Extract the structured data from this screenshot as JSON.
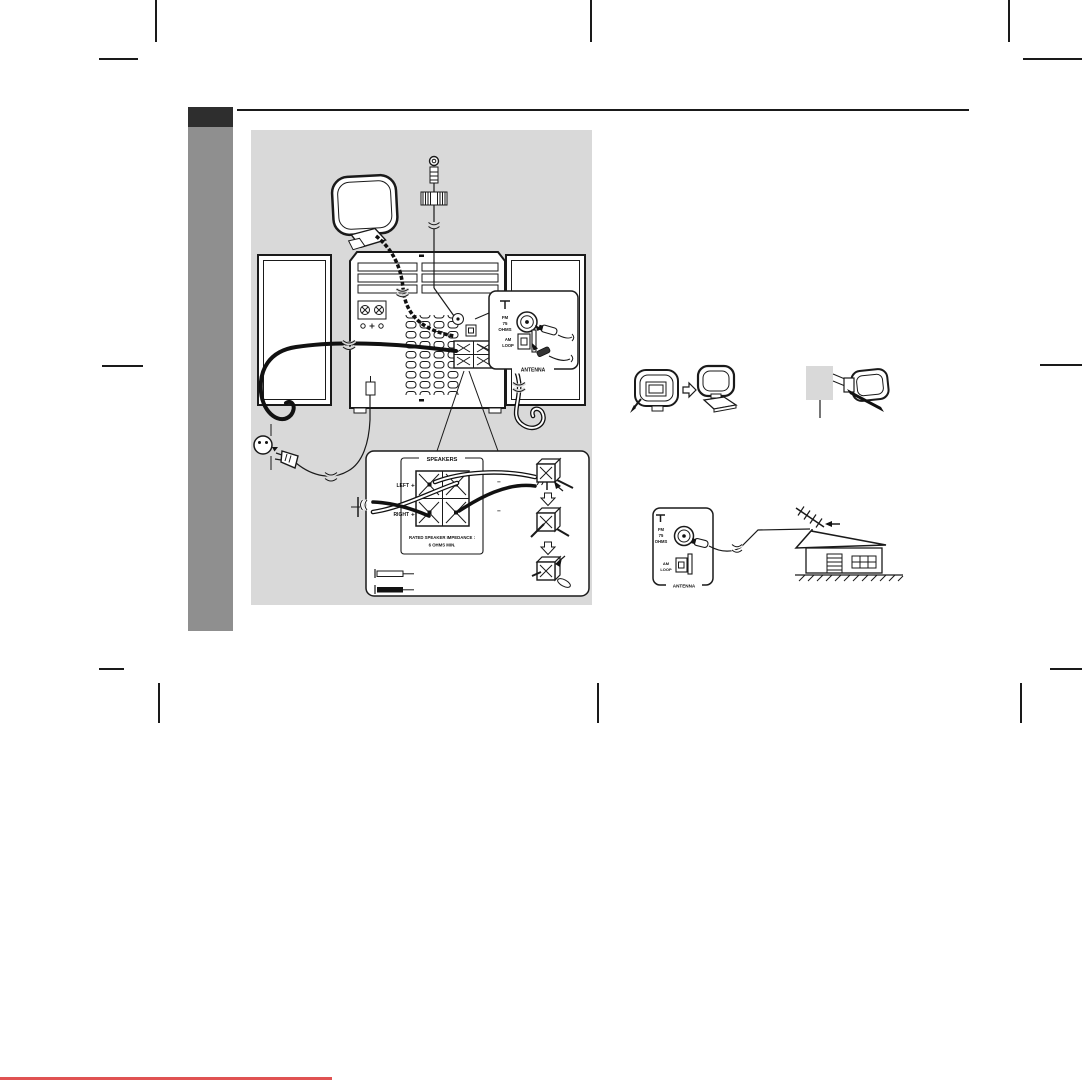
{
  "page": {
    "background": "#ffffff",
    "line_color": "#1a1a1a",
    "diagram_bg": "#d9d9d9",
    "sidebar_tab_color": "#2e2e2e",
    "sidebar_bar_color": "#8f8f8f",
    "red_rule_color": "#e05252"
  },
  "antenna_panel": {
    "fm_line1": "FM",
    "fm_line2": "75",
    "fm_line3": "OHMS",
    "am_line1": "AM",
    "am_line2": "LOOP",
    "label": "ANTENNA"
  },
  "speakers_panel": {
    "title": "SPEAKERS",
    "left_label": "LEFT",
    "right_label": "RIGHT",
    "plus": "+",
    "minus": "−",
    "impedance_line1": "RATED SPEAKER IMPEDANCE :",
    "impedance_line2": "6 OHMS MIN."
  },
  "icons": {
    "antenna_symbol": "t-mast",
    "assembly_arrow": "hollow-right-arrow",
    "insert_step_arrow": "hollow-down-arrow",
    "outdoor_antenna_pointer": "left-arrow"
  }
}
